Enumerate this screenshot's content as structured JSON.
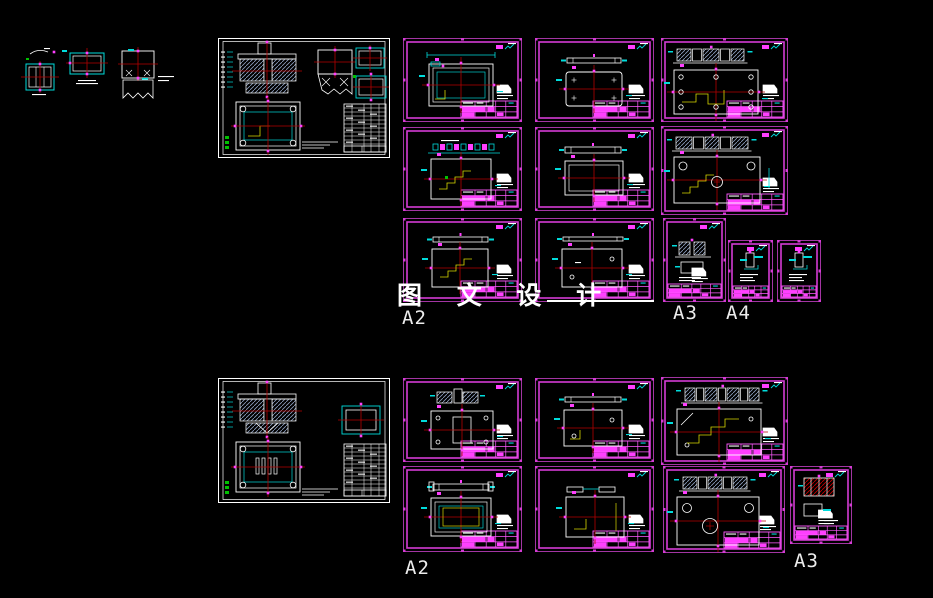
{
  "page": {
    "background": "#000000"
  },
  "watermark": {
    "text": "图 文 设 计"
  },
  "labels": {
    "a2_top": "A2",
    "a3_top": "A3",
    "a4_top": "A4",
    "a2_bottom": "A2",
    "a3_bottom": "A3"
  },
  "colors": {
    "border": "#a335a3",
    "border_inner": "#d43bd4",
    "title_line": "#ff5aff",
    "highlight": "#ff3fff",
    "dimension": "#00dcdc",
    "centerline": "#b40000",
    "auxiliary": "#d8d800",
    "green": "#00c000",
    "hatch": "#8ea0c0",
    "hatch_red": "#c80000",
    "outline": "#ffffff"
  }
}
